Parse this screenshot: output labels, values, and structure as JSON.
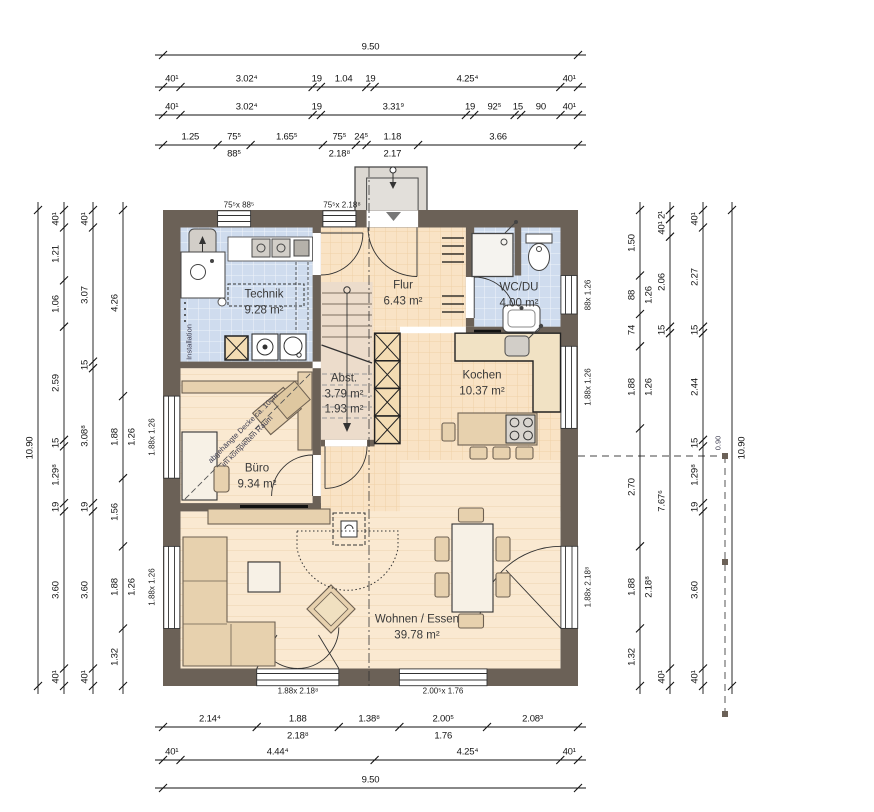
{
  "drawing": {
    "overall_width": "9.50",
    "overall_height": "10.90"
  },
  "colors": {
    "wall": "#6b6157",
    "tile_blue": "#cfdcee",
    "tile_warm": "#f9e3c5",
    "plank": "#fae9d1",
    "furniture": "#e7d1ae",
    "counter": "#f1e2c4",
    "appliance": "#d2cec8",
    "canopy": "#dcd8d2"
  },
  "rooms": [
    {
      "name": "Technik",
      "area": "9.28 m²",
      "x": 264,
      "y": 303
    },
    {
      "name": "Flur",
      "area": "6.43 m²",
      "x": 403,
      "y": 294
    },
    {
      "name": "WC/DU",
      "area": "4.00 m²",
      "x": 519,
      "y": 296
    },
    {
      "name": "Abst.",
      "area": "3.79 m²",
      "area2": "1.93 m²",
      "x": 344,
      "y": 395
    },
    {
      "name": "Kochen",
      "area": "10.37 m²",
      "x": 482,
      "y": 384
    },
    {
      "name": "Büro",
      "area": "9.34 m²",
      "x": 257,
      "y": 477
    },
    {
      "name": "Wohnen / Essen",
      "area": "39.78 m²",
      "x": 417,
      "y": 628
    }
  ],
  "dims": {
    "top": [
      [
        "9.50"
      ],
      [
        "40¹",
        "3.02⁴",
        "19",
        "1.04",
        "19",
        "4.25⁴",
        "40¹"
      ],
      [
        "40¹",
        "3.02⁴",
        "19",
        "3.31⁹",
        "19",
        "92⁵",
        "15",
        "90",
        "40¹"
      ],
      [
        {
          "t": "1.25"
        },
        {
          "t": "75⁵",
          "sub": "88⁵"
        },
        {
          "t": "1.65⁵"
        },
        {
          "t": "75⁵",
          "sub": "2.18⁸"
        },
        {
          "t": "24⁵"
        },
        {
          "t": "1.18",
          "sub": "2.17"
        },
        {
          "t": "3.66"
        }
      ]
    ],
    "bottom": [
      [
        {
          "t": "2.14⁴"
        },
        {
          "t": "1.88",
          "sub": "2.18⁸"
        },
        {
          "t": "1.38⁸"
        },
        {
          "t": "2.00⁵",
          "sub": "1.76"
        },
        {
          "t": "2.08³"
        }
      ],
      [
        "40¹",
        "4.44⁴",
        "4.25⁴",
        "40¹"
      ],
      [
        "9.50"
      ]
    ],
    "left": [
      [
        "10.90"
      ],
      [
        "40¹",
        "1.21",
        "1.06",
        "2.59",
        "15",
        "1.29⁸",
        "19",
        "3.60",
        "40¹"
      ],
      [
        "40¹",
        "3.07",
        "15",
        "3.08⁸",
        "19",
        "3.60",
        "40¹"
      ],
      [
        {
          "t": "4.26"
        },
        {
          "t": "1.88",
          "sub": "1.26"
        },
        {
          "t": "1.56"
        },
        {
          "t": "1.88",
          "sub": "1.26"
        },
        {
          "t": "1.32"
        }
      ]
    ],
    "right": [
      [
        {
          "t": "1.50"
        },
        {
          "t": "88",
          "sub": "1.26"
        },
        {
          "t": "74"
        },
        {
          "t": "1.88",
          "sub": "1.26"
        },
        {
          "t": "2.70"
        },
        {
          "t": "1.88",
          "sub": "2.18⁸"
        },
        {
          "t": "1.32"
        }
      ],
      [
        "2¹",
        "40¹",
        "2.06",
        "15",
        "7.67⁶",
        "40¹"
      ],
      [
        "40¹",
        "2.27",
        "15",
        "2.44",
        "15",
        "1.29⁸",
        "19",
        "3.60",
        "40¹"
      ],
      [
        "10.90"
      ]
    ]
  },
  "window_labels": [
    {
      "t": "75⁵x 88⁵",
      "x": 239,
      "y": 205
    },
    {
      "t": "75⁵x 2.18⁸",
      "x": 342,
      "y": 205
    },
    {
      "t": "1.88x 1.26",
      "x": 152,
      "y": 437,
      "v": 1
    },
    {
      "t": "1.88x 1.26",
      "x": 152,
      "y": 587,
      "v": 1
    },
    {
      "t": "88x 1.26",
      "x": 588,
      "y": 295,
      "v": 1
    },
    {
      "t": "1.88x 1.26",
      "x": 588,
      "y": 387,
      "v": 1
    },
    {
      "t": "1.88x 2.18⁸",
      "x": 588,
      "y": 587,
      "v": 1
    },
    {
      "t": "1.88x 2.18⁸",
      "x": 298,
      "y": 691
    },
    {
      "t": "2.00⁵x 1.76",
      "x": 443,
      "y": 691
    }
  ],
  "annotations": [
    {
      "t": "Installation",
      "x": 189,
      "y": 342,
      "v": 1
    },
    {
      "t": "abgehängte Decke ca. 10cm",
      "x": 243,
      "y": 428,
      "r45": 1
    },
    {
      "t": "im kompletten Raum",
      "x": 247,
      "y": 441,
      "r45": 1
    },
    {
      "t": "0.90",
      "x": 718,
      "y": 443,
      "v": 1
    }
  ]
}
